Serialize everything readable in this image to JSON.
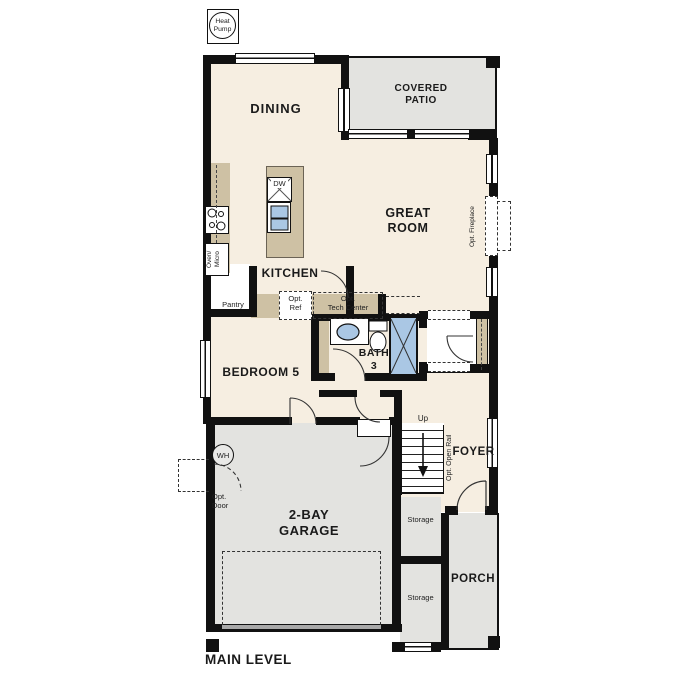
{
  "title": "MAIN LEVEL",
  "colors": {
    "wall": "#111111",
    "room_fill": "#f6eee1",
    "exterior_fill": "#e3e3e0",
    "counter_fill": "#cec1a4",
    "fixture_blue": "#aac7e4"
  },
  "labels": {
    "heat_pump": "Heat Pump",
    "dining": "DINING",
    "covered_patio": "COVERED PATIO",
    "great_room": "GREAT ROOM",
    "opt_fireplace": "Opt. Fireplace",
    "dw": "DW",
    "kitchen": "KITCHEN",
    "oven_micro": "Oven/ Micro",
    "pantry": "Pantry",
    "opt_ref": "Opt. Ref",
    "opt_tech_center_line1": "Opt.",
    "opt_tech_center_line2": "Tech Center",
    "bedroom5": "BEDROOM 5",
    "bath3": "BATH 3",
    "wh": "WH",
    "up": "Up",
    "opt_open_rail": "Opt. Open Rail",
    "foyer": "FOYER",
    "garage": "2-BAY GARAGE",
    "opt_door": "Opt. Door",
    "storage": "Storage",
    "porch": "PORCH",
    "main_level": "MAIN LEVEL"
  }
}
